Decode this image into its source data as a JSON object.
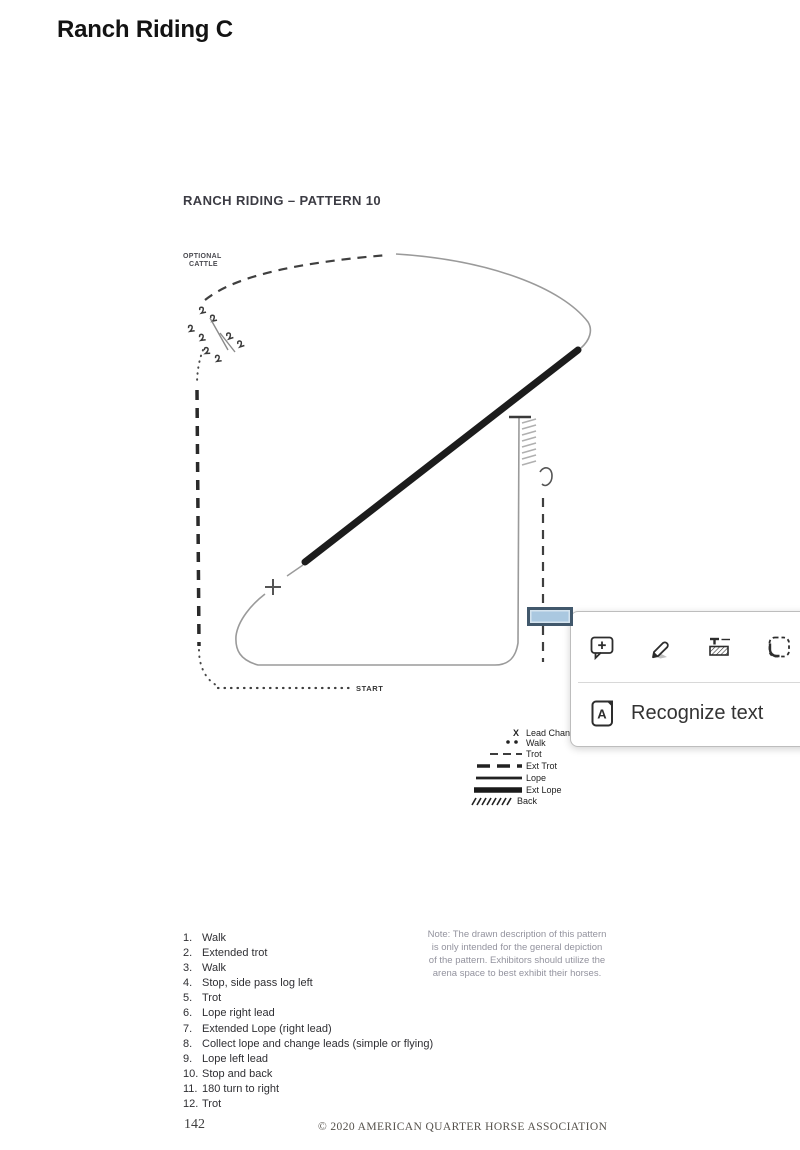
{
  "page": {
    "title": "Ranch Riding C"
  },
  "document": {
    "heading": "RANCH RIDING – PATTERN 10",
    "diagram": {
      "optional_cattle_line1": "OPTIONAL",
      "optional_cattle_line2": "CATTLE",
      "start_label": "START",
      "lead_change_marker": "X",
      "legend": [
        {
          "symbol": "lead-change-x",
          "label": "Lead Change"
        },
        {
          "symbol": "walk-dots",
          "label": "Walk"
        },
        {
          "symbol": "trot-dash",
          "label": "Trot"
        },
        {
          "symbol": "ext-trot-dash",
          "label": "Ext Trot"
        },
        {
          "symbol": "lope-line",
          "label": "Lope"
        },
        {
          "symbol": "ext-lope-line",
          "label": "Ext Lope"
        },
        {
          "symbol": "back-hatch",
          "label": "Back"
        }
      ]
    },
    "instructions": [
      {
        "num": "1.",
        "text": "Walk"
      },
      {
        "num": "2.",
        "text": "Extended trot"
      },
      {
        "num": "3.",
        "text": "Walk"
      },
      {
        "num": "4.",
        "text": "Stop, side pass log left"
      },
      {
        "num": "5.",
        "text": "Trot"
      },
      {
        "num": "6.",
        "text": "Lope right lead"
      },
      {
        "num": "7.",
        "text": "Extended Lope (right lead)"
      },
      {
        "num": "8.",
        "text": "Collect lope and change leads (simple or flying)"
      },
      {
        "num": "9.",
        "text": "Lope left lead"
      },
      {
        "num": "10.",
        "text": "Stop and back"
      },
      {
        "num": "11.",
        "text": "180 turn to right"
      },
      {
        "num": "12.",
        "text": "Trot"
      }
    ],
    "note": "Note: The drawn description of this pattern is only intended for the general depiction of the pattern. Exhibitors should utilize the arena space to best exhibit their horses.",
    "page_number": "142",
    "copyright": "© 2020 AMERICAN QUARTER HORSE ASSOCIATION"
  },
  "popup": {
    "recognize_label": "Recognize text",
    "tools": [
      "add-comment",
      "pencil-annotate",
      "redact-text",
      "select-region",
      "recognize-text"
    ]
  },
  "annotation": {
    "highlight_fill": "#aac8e0",
    "highlight_border": "#41586c"
  }
}
